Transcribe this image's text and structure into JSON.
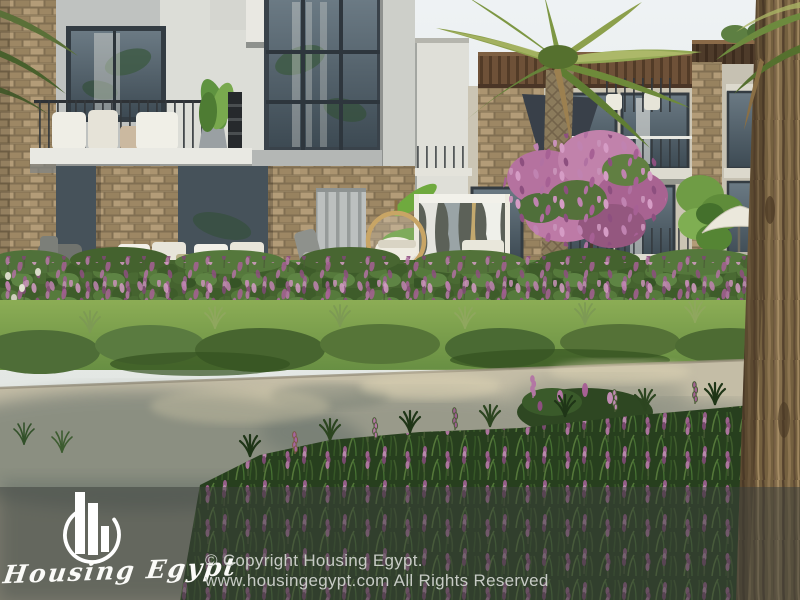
{
  "watermark": {
    "brand_name": "Housing Egypt",
    "logo_icon": "skyline-bars-in-circle-icon",
    "copyright_line1": "© Copyright Housing Egypt.",
    "copyright_line2": "www.housingegypt.com All Rights Reserved",
    "overlay_color": "rgba(60,64,60,0.52)",
    "text_color": "#c7cbc5"
  },
  "scene": {
    "subject": "Rendered residential compound with stone-clad villas, palm trees, flowering gardens and a road",
    "palette": {
      "sky": "#e9eef1",
      "facade_light": "#dcddd7",
      "facade_gray": "#bfc2c0",
      "facade_beige": "#cbc5b4",
      "stone": "#a8926f",
      "glass": "#46545e",
      "lawn": "#83a855",
      "hedge": "#45632f",
      "flower_pink": "#bd7aa6",
      "road": "#c4bda6",
      "road_shadow": "#66716b",
      "bark": "#74603f"
    }
  }
}
